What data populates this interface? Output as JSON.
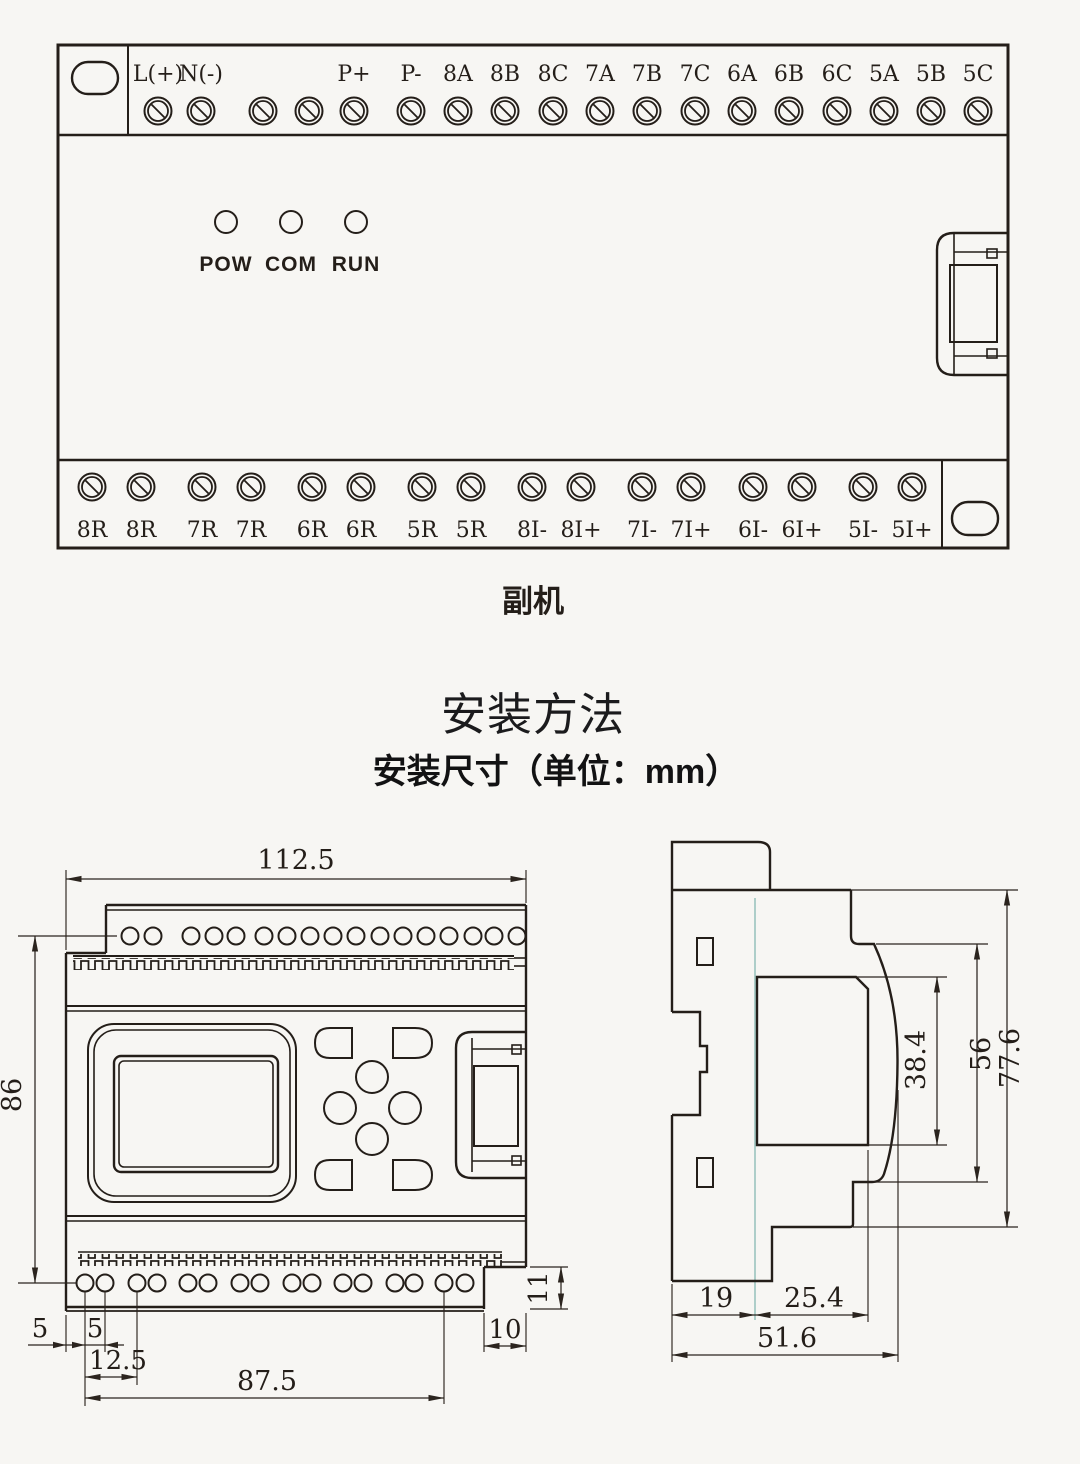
{
  "device_panel": {
    "model_label": "副机",
    "leds": [
      "POW",
      "COM",
      "RUN"
    ],
    "top_terminals": [
      "L(+)",
      "N(-)",
      "P+",
      "P-",
      "8A",
      "8B",
      "8C",
      "7A",
      "7B",
      "7C",
      "6A",
      "6B",
      "6C",
      "5A",
      "5B",
      "5C"
    ],
    "bottom_terminals": [
      "8R",
      "8R",
      "7R",
      "7R",
      "6R",
      "6R",
      "5R",
      "5R",
      "8I-",
      "8I+",
      "7I-",
      "7I+",
      "6I-",
      "6I+",
      "5I-",
      "5I+"
    ]
  },
  "section": {
    "title": "安装方法",
    "subtitle": "安装尺寸（单位：mm）"
  },
  "front_view": {
    "width": "112.5",
    "height": "86",
    "edge_to_hole": "5",
    "hole_pitch": "5",
    "hole_group_pitch": "12.5",
    "hole_span": "87.5",
    "notch_width": "10",
    "notch_height": "11"
  },
  "side_view": {
    "total_height": "77.6",
    "front_height": "56",
    "window_height": "38.4",
    "back_depth": "19",
    "front_depth": "25.4",
    "total_depth": "51.6"
  },
  "colors": {
    "line": "#241e19",
    "dimension": "#2b241e",
    "background": "#f7f6f3",
    "rail_mark": "#86b8b3"
  }
}
